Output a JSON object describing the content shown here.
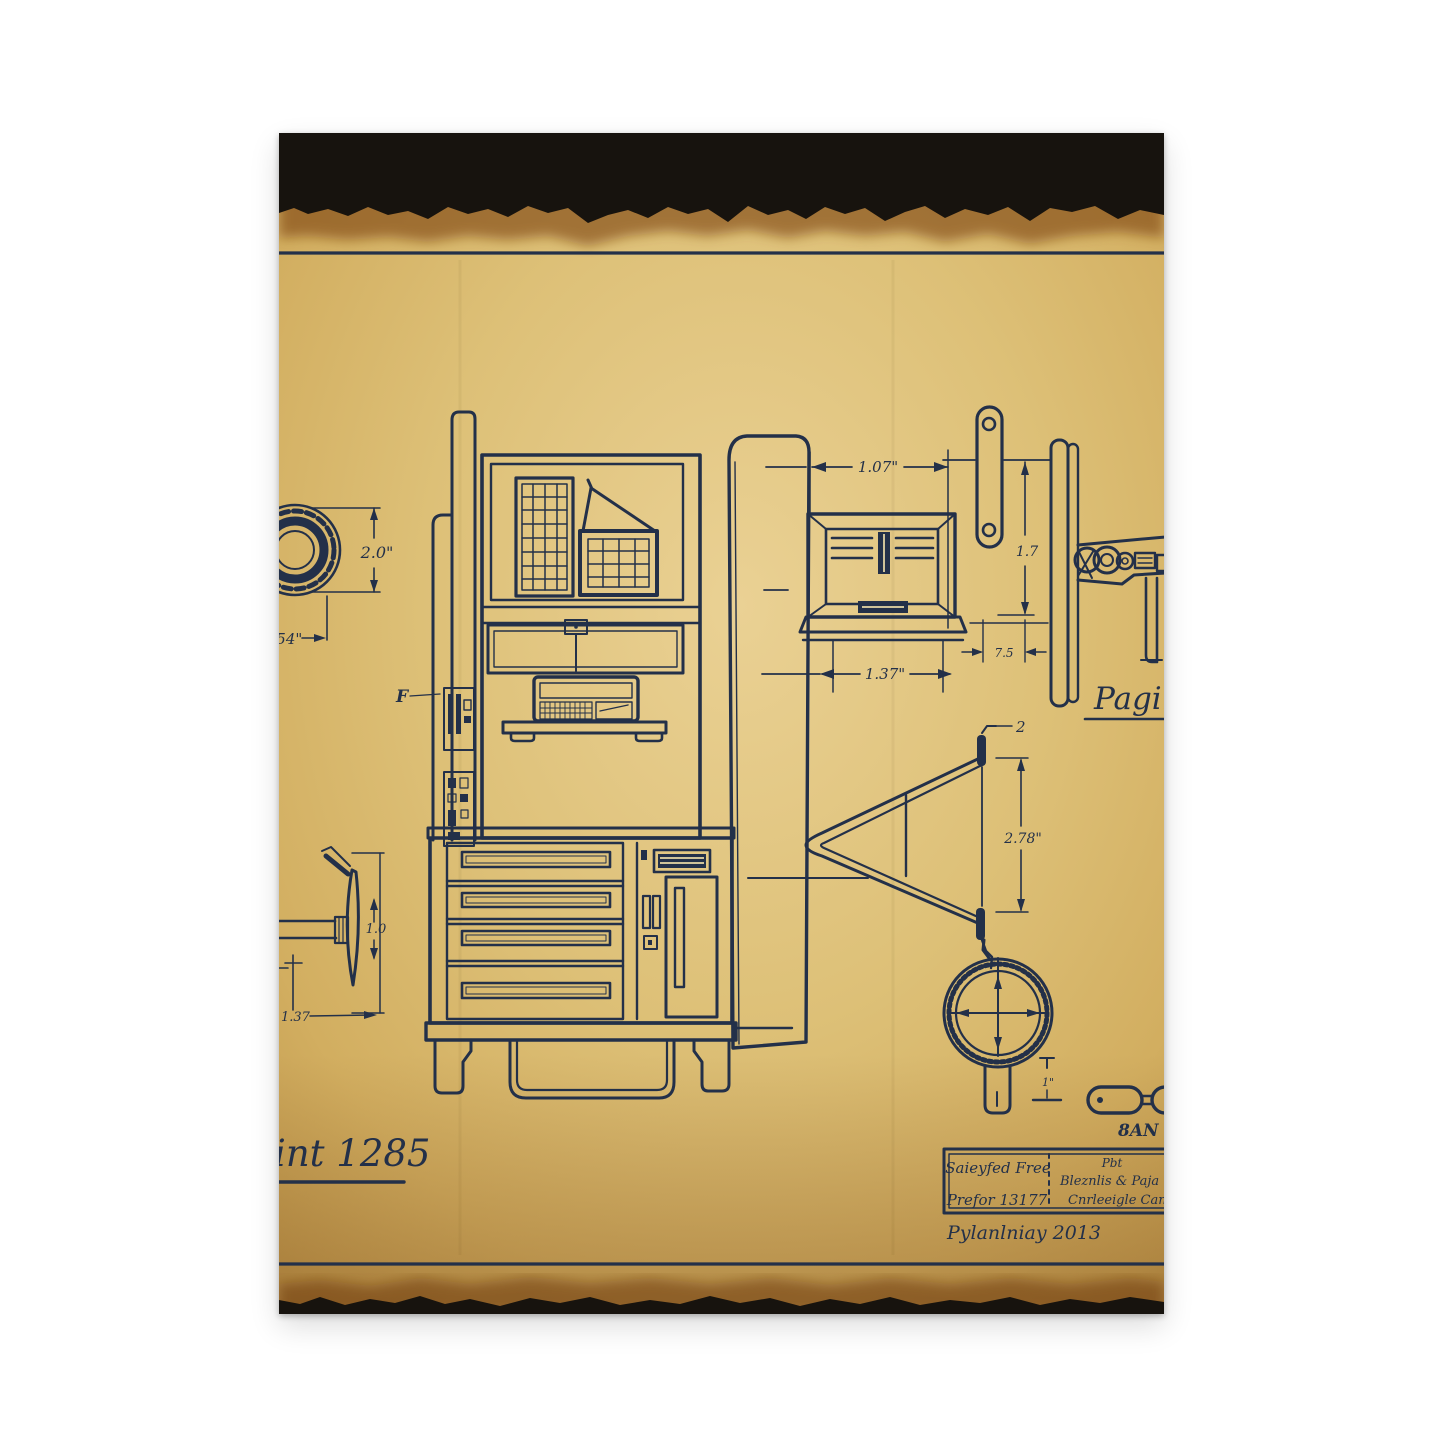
{
  "artwork": {
    "description": "Vintage blueprint-style patent drawing of a cabinet machine, printed on aged scorched paper, shown as a canvas print on white background",
    "colors": {
      "background": "#ffffff",
      "paper": "#d9ba70",
      "paper_light": "#e9d092",
      "paper_edge": "#bd954a",
      "ink": "#233049",
      "burn": "#17130e",
      "border_line": "#38332a"
    },
    "labels": {
      "print_title": "int 1285",
      "page_script": "Pagin",
      "part_f": "F",
      "part_two": "2",
      "pan": "8AN"
    },
    "dimensions": {
      "bearing_height": "2.0\"",
      "bearing_offset": "1.54\"",
      "vent_top_width": "1.07\"",
      "vent_bottom_width": "1.37\"",
      "strap_height": "1.7",
      "strap_width": "7.5",
      "vbracket_height": "2.78\"",
      "wheel_height": "1.0",
      "wheel_offset": "1.37",
      "gauge_stem": "1\""
    },
    "title_block": {
      "left_top": "Saieyfed Free",
      "left_bottom": "Prefor 13177",
      "right_line1": "Pbt",
      "right_line2": "Bleznlis & Paja",
      "right_line3": "Cnrleeigle Can",
      "signature": "Pylanlniay 2013"
    }
  }
}
